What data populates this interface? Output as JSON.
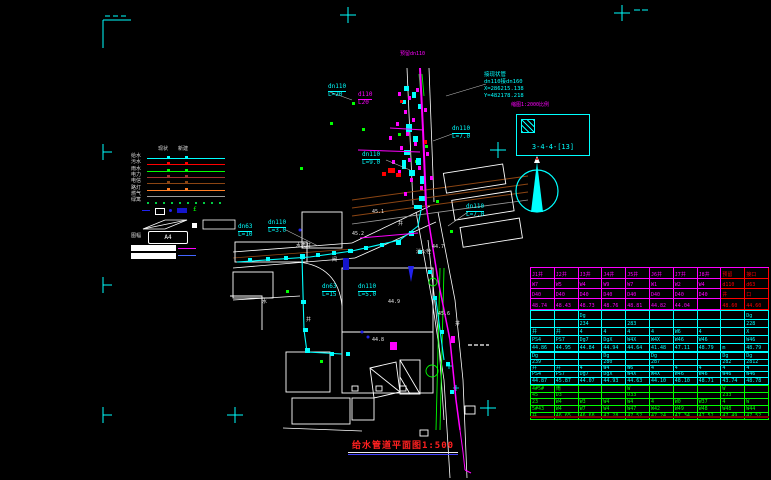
{
  "colors": {
    "background": "#000000",
    "cyan": "#00FFFF",
    "magenta": "#FF00FF",
    "red": "#FF0000",
    "green": "#00FF00",
    "white": "#FFFFFF",
    "brown": "#8B4513",
    "darkred": "#A03030",
    "orange": "#FF7F27",
    "grey": "#9A9A9A",
    "navy": "#1515CC",
    "title_red": "#FF2020",
    "table_underline": "#800000"
  },
  "title": {
    "text": "给水管道平面图1:500"
  },
  "index_box": {
    "label": "缩图1:2000比例",
    "code": "3-4-4-[13]"
  },
  "coord_block": {
    "line1": "接现状管",
    "line2": "dn110接dn160",
    "line3": "X=286215.138",
    "line4": "Y=482178.218"
  },
  "top_note": {
    "text": "预留dn110"
  },
  "north_arrow": {
    "label": "north-arrow"
  },
  "legend": {
    "headers": [
      "现状",
      "新建"
    ],
    "rows": [
      {
        "label": "给水",
        "color": "#00FFFF",
        "dots": false
      },
      {
        "label": "污水",
        "color": "#FF0000",
        "dots": false
      },
      {
        "label": "雨水",
        "color": "#00FF00",
        "dots": false
      },
      {
        "label": "电力",
        "color": "#A03030",
        "dots": false
      },
      {
        "label": "电信",
        "color": "#8B4513",
        "dots": false
      },
      {
        "label": "路灯",
        "color": "#FF7F27",
        "dots": false
      },
      {
        "label": "燃气",
        "color": "#9A9A9A",
        "dots": false
      },
      {
        "label": "绿篱",
        "color": "#00CC44",
        "dots": true
      }
    ],
    "box_label": "图幅",
    "box_text": "A4"
  },
  "pipe_labels": [
    {
      "l1": "dn110",
      "l2": "L=20",
      "x": 328,
      "y": 84,
      "color": "#00FFFF"
    },
    {
      "l1": "d110",
      "l2": "L20",
      "x": 358,
      "y": 92,
      "color": "#FF00FF"
    },
    {
      "l1": "dn110",
      "l2": "L=7.0",
      "x": 452,
      "y": 126,
      "color": "#00FFFF"
    },
    {
      "l1": "dn110",
      "l2": "L=9.0",
      "x": 362,
      "y": 152,
      "color": "#00FFFF"
    },
    {
      "l1": "dn63",
      "l2": "L=10",
      "x": 238,
      "y": 224,
      "color": "#00FFFF"
    },
    {
      "l1": "dn110",
      "l2": "L=3.0",
      "x": 268,
      "y": 220,
      "color": "#00FFFF"
    },
    {
      "l1": "dn63",
      "l2": "L=15",
      "x": 322,
      "y": 284,
      "color": "#00FFFF"
    },
    {
      "l1": "dn110",
      "l2": "L=5.0",
      "x": 358,
      "y": 284,
      "color": "#00FFFF"
    },
    {
      "l1": "dn110",
      "l2": "L=7.0",
      "x": 466,
      "y": 204,
      "color": "#00FFFF"
    }
  ],
  "scatter_text": [
    {
      "t": "水表井",
      "x": 296,
      "y": 244
    },
    {
      "t": "阀",
      "x": 332,
      "y": 258
    },
    {
      "t": "45.2",
      "x": 352,
      "y": 232
    },
    {
      "t": "消火栓",
      "x": 416,
      "y": 250
    },
    {
      "t": "44.8",
      "x": 372,
      "y": 338
    },
    {
      "t": "井",
      "x": 306,
      "y": 318
    },
    {
      "t": "水",
      "x": 262,
      "y": 300
    },
    {
      "t": "45.6",
      "x": 438,
      "y": 312
    },
    {
      "t": "井",
      "x": 455,
      "y": 322
    },
    {
      "t": "44.9",
      "x": 388,
      "y": 300
    },
    {
      "t": "45.1",
      "x": 372,
      "y": 210
    },
    {
      "t": "井",
      "x": 398,
      "y": 222
    },
    {
      "t": "44.7",
      "x": 432,
      "y": 245
    }
  ],
  "table": {
    "groups": [
      {
        "color": "#FF00FF",
        "redFrom": 8,
        "redColor": "#FF0000",
        "rowHeights": [
          11,
          10,
          10,
          11
        ],
        "rows": [
          [
            "J1井",
            "J2井",
            "J3井",
            "J4井",
            "J5井",
            "J6井",
            "J7井",
            "J8井",
            "预留",
            "接口"
          ],
          [
            "W7",
            "W5",
            "W4",
            "W9",
            "W7",
            "W1",
            "W2",
            "W4",
            "d110",
            "d63"
          ],
          [
            "D40",
            "D40",
            "D40",
            "D40",
            "D40",
            "D40",
            "D40",
            "D40",
            "井",
            "口"
          ],
          [
            "48.74",
            "48.43",
            "48.73",
            "48.76",
            "48.81",
            "44.82",
            "44.04",
            "",
            "48.60",
            "44.60"
          ]
        ]
      },
      {
        "color": "#00FFFF",
        "rowHeights": [
          9,
          8,
          8,
          8,
          8
        ],
        "rows": [
          [
            "",
            "",
            "Dg",
            "",
            "",
            "",
            "",
            "",
            "",
            "Dg"
          ],
          [
            "",
            "",
            "234",
            "",
            "283",
            "",
            "",
            "",
            "",
            "228"
          ],
          [
            "井",
            "井",
            "4",
            "4",
            "4",
            "4",
            "W6",
            "4",
            "",
            "X"
          ],
          [
            "PS4",
            "PS7",
            "Dg7",
            "DgX",
            "W4X",
            "W4X",
            "W46",
            "W46",
            "",
            "W46"
          ],
          [
            "44.86",
            "44.95",
            "44.84",
            "44.94",
            "44.64",
            "41.48",
            "47.11",
            "48.79",
            "m",
            "48.79"
          ]
        ]
      },
      {
        "color": "#00FFFF",
        "rowHeights": [
          7,
          6,
          6,
          6,
          7
        ],
        "rows": [
          [
            "Dg",
            "",
            "",
            "Dg",
            "",
            "Dg",
            "",
            "",
            "Dg",
            "Dg"
          ],
          [
            "239",
            "",
            "",
            "280",
            "",
            "287",
            "",
            "",
            "282",
            "2812"
          ],
          [
            "井",
            "井",
            "4",
            "W4",
            "W6",
            "4",
            "4",
            "4",
            "4",
            "4"
          ],
          [
            "PS4",
            "PS7",
            "Dg7",
            "DgX",
            "W4X",
            "W4X",
            "W46",
            "W46",
            "W46",
            "W46"
          ],
          [
            "44.87",
            "45.87",
            "44.07",
            "44.93",
            "44.63",
            "44.10",
            "48.10",
            "48.71",
            "43.74",
            "48.78"
          ]
        ]
      },
      {
        "color": "#00FF00",
        "rowHeights": [
          7,
          6,
          7,
          7,
          7
        ],
        "rows": [
          [
            "4#5#",
            "雨",
            "",
            "",
            "W",
            "",
            "",
            "",
            "W",
            ""
          ],
          [
            "45",
            "D3",
            "",
            "",
            "D33",
            "",
            "",
            "",
            "233",
            ""
          ],
          [
            "23",
            "W4",
            "W3",
            "W4",
            "W4",
            "4",
            "W0",
            "W37",
            "4",
            "W"
          ],
          [
            "5#43",
            "W4",
            "W7",
            "W4",
            "W47",
            "W42",
            "W49",
            "W48",
            "W48",
            "W44"
          ],
          [
            "井",
            "46.65",
            "46.68",
            "47.28",
            "47.52",
            "47.24",
            "47.34",
            "47.52",
            "47.49",
            "47.52"
          ]
        ]
      }
    ]
  }
}
